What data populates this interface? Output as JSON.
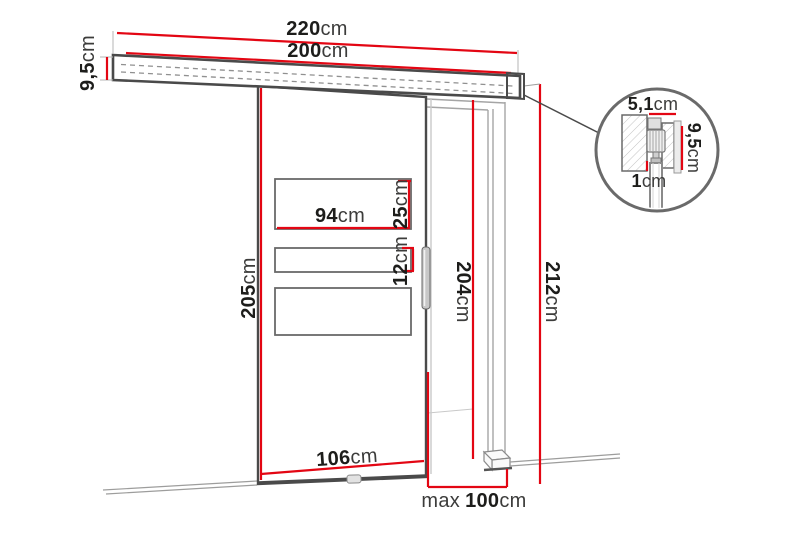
{
  "diagram": {
    "type": "sliding-door dimension drawing",
    "colors": {
      "dimension_red": "#e30613",
      "line_dark": "#4a4a4a",
      "line_light": "#9d9d9c",
      "text_dark": "#1d1d1b"
    }
  },
  "labels": {
    "rail_length_total": {
      "value": "220",
      "unit": "cm"
    },
    "rail_length_track": {
      "value": "200",
      "unit": "cm"
    },
    "rail_profile_height": {
      "value": "9,5",
      "unit": "cm"
    },
    "door_panel_height": {
      "value": "205",
      "unit": "cm"
    },
    "glass_width": {
      "value": "94",
      "unit": "cm"
    },
    "glass_top_height": {
      "value": "25",
      "unit": "cm"
    },
    "glass_middle_height": {
      "value": "12",
      "unit": "cm"
    },
    "doorway_height": {
      "value": "204",
      "unit": "cm"
    },
    "overall_height": {
      "value": "212",
      "unit": "cm"
    },
    "door_panel_width": {
      "value": "106",
      "unit": "cm"
    },
    "doorway_max_width": {
      "prefix": "max",
      "value": "100",
      "unit": "cm"
    },
    "detail_rail_width": {
      "value": "5,1",
      "unit": "cm"
    },
    "detail_rail_height": {
      "value": "9,5",
      "unit": "cm"
    },
    "detail_clearance": {
      "value": "1",
      "unit": "cm"
    }
  }
}
